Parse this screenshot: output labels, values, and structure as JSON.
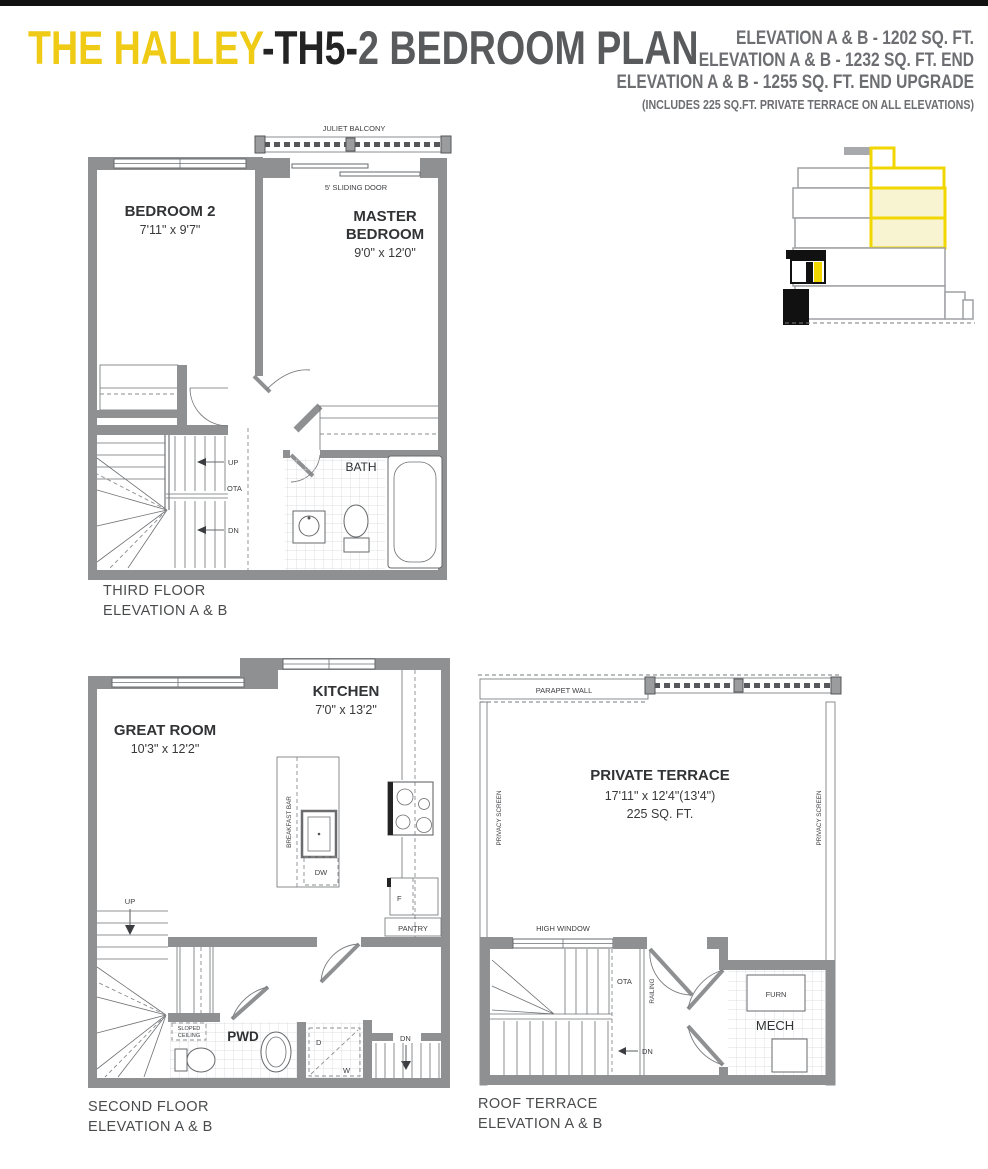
{
  "page": {
    "title_brand": "THE HALLEY",
    "title_model": "-TH5-",
    "title_rest": "2 BEDROOM PLAN"
  },
  "header": {
    "line1": "ELEVATION A & B - 1202 SQ. FT.",
    "line2": "ELEVATION A & B - 1232 SQ. FT. END",
    "line3": "ELEVATION A & B - 1255 SQ. FT. END UPGRADE",
    "note": "(INCLUDES 225 SQ.FT. PRIVATE TERRACE ON ALL ELEVATIONS)"
  },
  "colors": {
    "brand_yellow": "#EFCB16",
    "title_dark": "#232323",
    "title_gray": "#595A5C",
    "header_gray": "#6D6E71",
    "wall_gray": "#8E9092",
    "key_plan_yellow": "#F2D600",
    "key_plan_pale_yellow": "#F8F4D2"
  },
  "third_floor": {
    "balcony_label": "JULIET BALCONY",
    "sliding_door_label": "5' SLIDING DOOR",
    "bedroom2_name": "BEDROOM 2",
    "bedroom2_dims": "7'11\" x 9'7\"",
    "master_name1": "MASTER",
    "master_name2": "BEDROOM",
    "master_dims": "9'0\" x 12'0\"",
    "bath_label": "BATH",
    "up_label": "UP",
    "ota_label": "OTA",
    "dn_label": "DN",
    "caption_line1": "THIRD FLOOR",
    "caption_line2": "ELEVATION A & B"
  },
  "second_floor": {
    "great_room_name": "GREAT ROOM",
    "great_room_dims": "10'3\" x 12'2\"",
    "kitchen_name": "KITCHEN",
    "kitchen_dims": "7'0\" x 13'2\"",
    "breakfast_bar_label": "BREAKFAST BAR",
    "dw_label": "DW",
    "f_label": "F",
    "pantry_label": "PANTRY",
    "up_label": "UP",
    "dn_label": "DN",
    "pwd_label": "PWD",
    "sloped1": "SLOPED",
    "sloped2": "CEILING",
    "d_label": "D",
    "w_label": "W",
    "caption_line1": "SECOND FLOOR",
    "caption_line2": "ELEVATION A & B"
  },
  "roof_terrace": {
    "parapet_label": "PARAPET WALL",
    "privacy_left": "PRIVACY SCREEN",
    "privacy_right": "PRIVACY SCREEN",
    "terrace_name": "PRIVATE TERRACE",
    "terrace_dims": "17'11\" x 12'4\"(13'4\")",
    "terrace_area": "225 SQ. FT.",
    "high_window_label": "HIGH WINDOW",
    "ota_label": "OTA",
    "railing_label": "RAILING",
    "dn_label": "DN",
    "furn_label": "FURN",
    "mech_label": "MECH",
    "caption_line1": "ROOF TERRACE",
    "caption_line2": "ELEVATION A & B"
  }
}
